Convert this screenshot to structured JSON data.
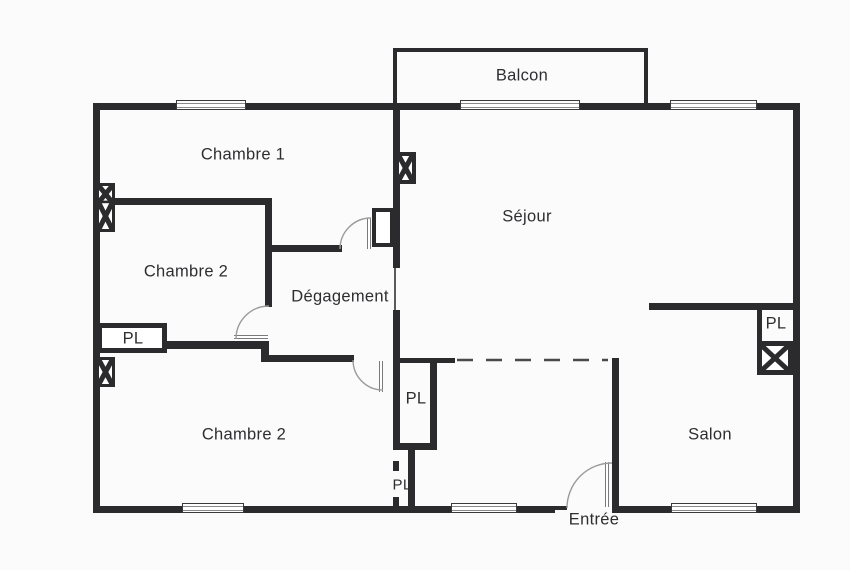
{
  "floorplan": {
    "colors": {
      "wall": "#2b2b2e",
      "background": "#fbfbfb",
      "door_arc": "#9b9b9b",
      "text": "#2e2e31"
    },
    "rooms": {
      "balcon": {
        "label": "Balcon"
      },
      "chambre1": {
        "label": "Chambre 1"
      },
      "sejour": {
        "label": "Séjour"
      },
      "chambre2_mid": {
        "label": "Chambre 2"
      },
      "degagement": {
        "label": "Dégagement"
      },
      "chambre2_bottom": {
        "label": "Chambre 2"
      },
      "salon": {
        "label": "Salon"
      },
      "entree": {
        "label": "Entrée"
      }
    },
    "closets": {
      "pl_left": {
        "label": "PL"
      },
      "pl_center": {
        "label": "PL"
      },
      "pl_lower": {
        "label": "PL"
      },
      "pl_right": {
        "label": "PL"
      }
    },
    "symbols": {
      "window": "double-line-window",
      "duct_shaft": "crossed-box",
      "door": "quarter-circle-swing"
    }
  }
}
